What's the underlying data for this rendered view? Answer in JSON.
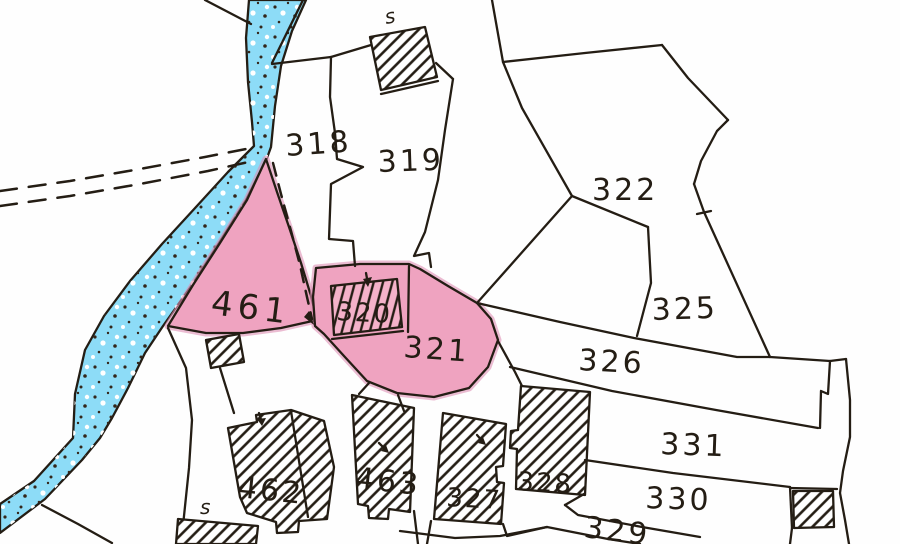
{
  "map": {
    "description": "Hand-drawn cadastral parcel sketch map with a blue stream, dashed road, pink highlighted parcels and hatched buildings",
    "colors": {
      "background": "#fefefe",
      "ink": "#241d14",
      "water_blue": "#8ddcf7",
      "highlight_pink": "#efa3c0",
      "highlight_pink_edge": "#dd8fb4"
    },
    "water_feature": {
      "kind": "stream",
      "style": "blue band with speckles"
    },
    "road": {
      "kind": "track",
      "style": "double dashed line"
    },
    "footpath": {
      "kind": "path",
      "style": "dashed line with arrow through parcel 461"
    }
  },
  "highlighted_parcels": [
    "461",
    "320",
    "321"
  ],
  "parcels": [
    {
      "id": "318",
      "highlighted": false
    },
    {
      "id": "319",
      "highlighted": false
    },
    {
      "id": "320",
      "highlighted": true
    },
    {
      "id": "321",
      "highlighted": true
    },
    {
      "id": "322",
      "highlighted": false
    },
    {
      "id": "325",
      "highlighted": false
    },
    {
      "id": "326",
      "highlighted": false
    },
    {
      "id": "327",
      "highlighted": false
    },
    {
      "id": "328",
      "highlighted": false
    },
    {
      "id": "329",
      "highlighted": false
    },
    {
      "id": "330",
      "highlighted": false
    },
    {
      "id": "331",
      "highlighted": false
    },
    {
      "id": "461",
      "highlighted": true
    },
    {
      "id": "462",
      "highlighted": false
    },
    {
      "id": "463",
      "highlighted": false
    }
  ],
  "labels": {
    "p318": "318",
    "p319": "319",
    "p320": "320",
    "p321": "321",
    "p322": "322",
    "p325": "325",
    "p326": "326",
    "p327": "327",
    "p328": "328",
    "p329": "329",
    "p330": "330",
    "p331": "331",
    "p461": "461",
    "p462": "462",
    "p463": "463",
    "s_top": "s",
    "s_bottom": "s"
  }
}
